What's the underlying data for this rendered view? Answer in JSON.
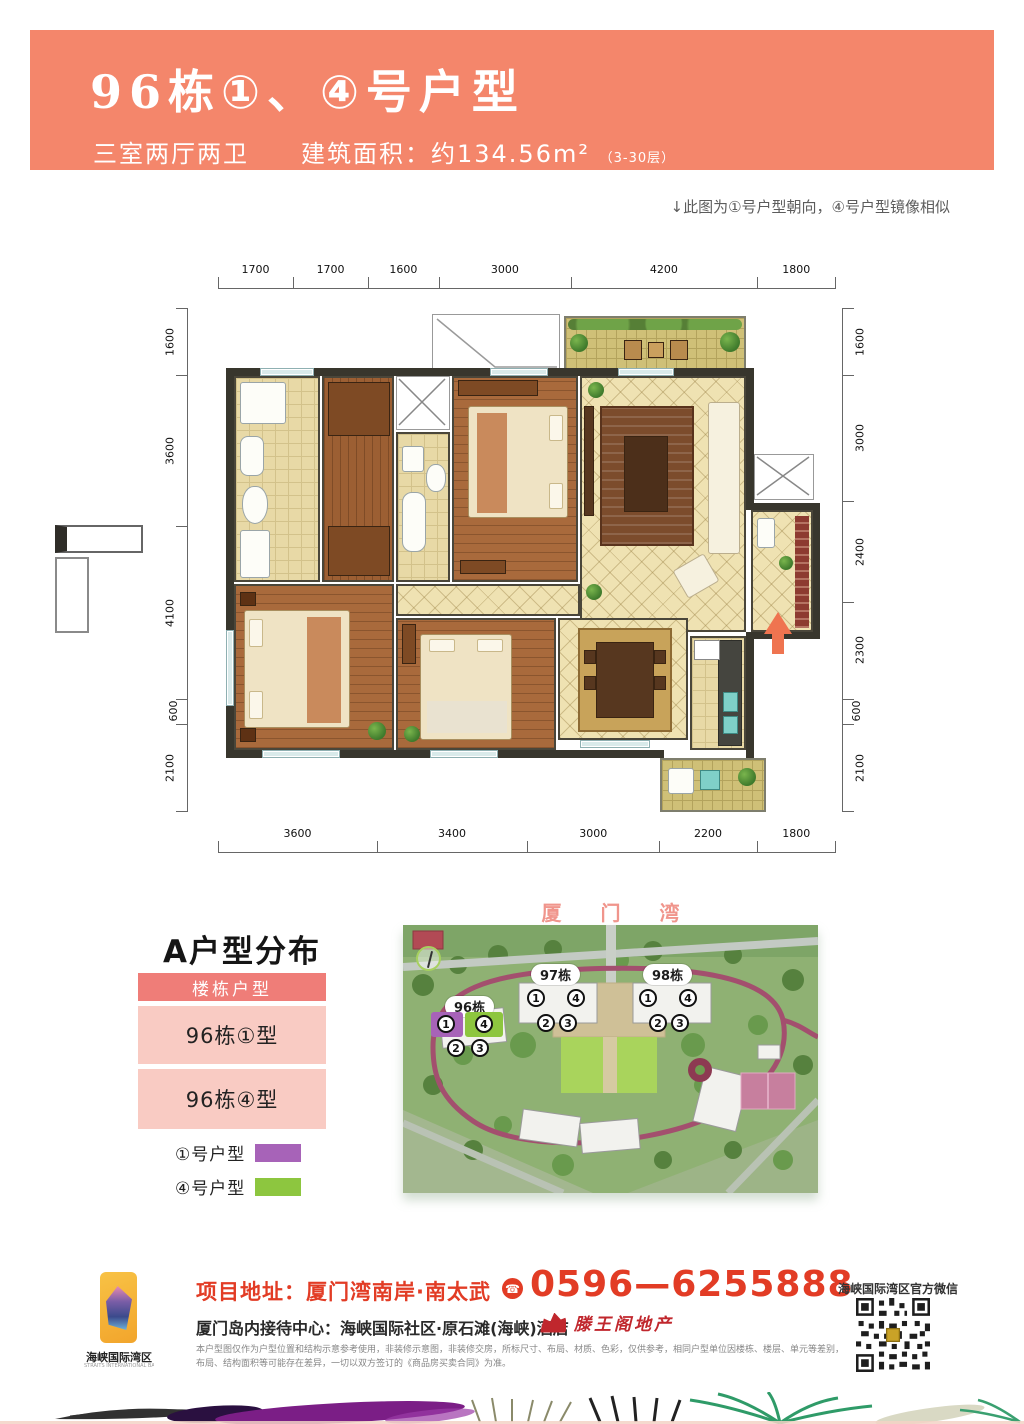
{
  "banner": {
    "title": "96栋①、④号户型",
    "subtitle_rooms": "三室两厅两卫",
    "subtitle_area": "建筑面积：约134.56m²",
    "subtitle_floors": "（3-30层）",
    "bg_color": "#f4866b"
  },
  "note": "↓此图为①号户型朝向，④号户型镜像相似",
  "floorplan": {
    "dims_top": [
      "1700",
      "1700",
      "1600",
      "3000",
      "4200",
      "1800"
    ],
    "dims_bottom": [
      "3600",
      "3400",
      "3000",
      "2200",
      "1800"
    ],
    "dims_left": [
      "1600",
      "3600",
      "4100",
      "600",
      "2100"
    ],
    "dims_right": [
      "1600",
      "3000",
      "2400",
      "2300",
      "600",
      "2100"
    ]
  },
  "distribution": {
    "title": "A户型分布",
    "table_header": "楼栋户型",
    "rows": [
      "96栋①型",
      "96栋④型"
    ],
    "legend": [
      {
        "label": "①号户型",
        "color": "#a763b8"
      },
      {
        "label": "④号户型",
        "color": "#8dc63f"
      }
    ]
  },
  "sitemap": {
    "title": "厦 门 湾",
    "unit1_color": "#a763b8",
    "unit4_color": "#8dc63f",
    "buildings": [
      {
        "name": "96栋",
        "units": [
          "1",
          "4",
          "2",
          "3"
        ]
      },
      {
        "name": "97栋",
        "units": [
          "1",
          "4",
          "2",
          "3"
        ]
      },
      {
        "name": "98栋",
        "units": [
          "1",
          "4",
          "2",
          "3"
        ]
      }
    ]
  },
  "footer": {
    "logo_title": "海峡国际湾区",
    "logo_subtitle": "STRAITS INTERNATIONAL BAY AREA",
    "address": "项目地址：厦门湾南岸·南太武",
    "phone_icon": "☎",
    "phone": "0596—6255888",
    "reception": "厦门岛内接待中心：海峡国际社区·原石滩(海峡)酒店",
    "developer": "滕王阁地产",
    "wechat_label": "海峡国际湾区官方微信",
    "disclaimer": "本户型图仅作为户型位置和结构示意参考使用，非装修示意图，非装修交房，所标尺寸、布局、材质、色彩，仅供参考，相同户型单位因楼栋、楼层、单元等差别，布局、结构面积等可能存在差异，一切以双方签订的《商品房买卖合同》为准。"
  }
}
